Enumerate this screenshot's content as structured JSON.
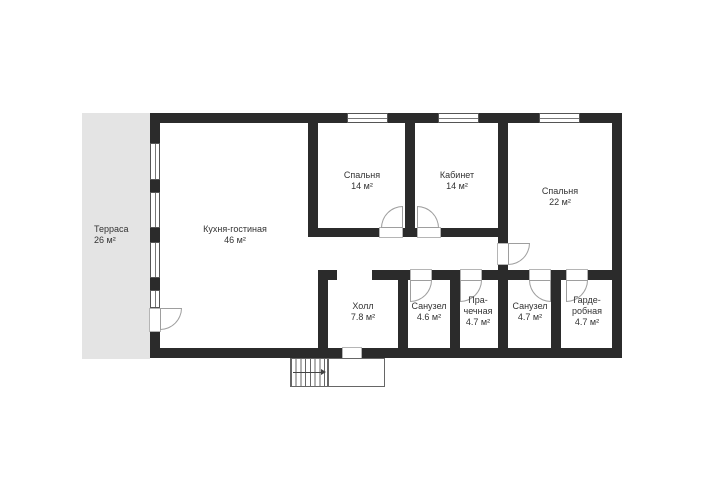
{
  "theme": {
    "wall_color": "#2b2b2b",
    "terrace_fill": "#e4e4e4",
    "line_color": "#9e9e9e",
    "text_color": "#333333",
    "background": "#ffffff"
  },
  "floor_plan": {
    "terrace": {
      "name": "Терраса",
      "area": "26 м²"
    },
    "rooms": [
      {
        "name": "Кухня-гостиная",
        "area": "46 м²"
      },
      {
        "name": "Спальня",
        "area": "14 м²"
      },
      {
        "name": "Кабинет",
        "area": "14 м²"
      },
      {
        "name": "Спальня",
        "area": "22 м²"
      },
      {
        "name": "Холл",
        "area": "7.8 м²"
      },
      {
        "name": "Санузел",
        "area": "4.6 м²"
      },
      {
        "name_line1": "Пра-",
        "name_line2": "чечная",
        "area": "4.7 м²"
      },
      {
        "name": "Санузел",
        "area": "4.7 м²"
      },
      {
        "name_line1": "Гарде-",
        "name_line2": "робная",
        "area": "4.7 м²"
      }
    ]
  }
}
